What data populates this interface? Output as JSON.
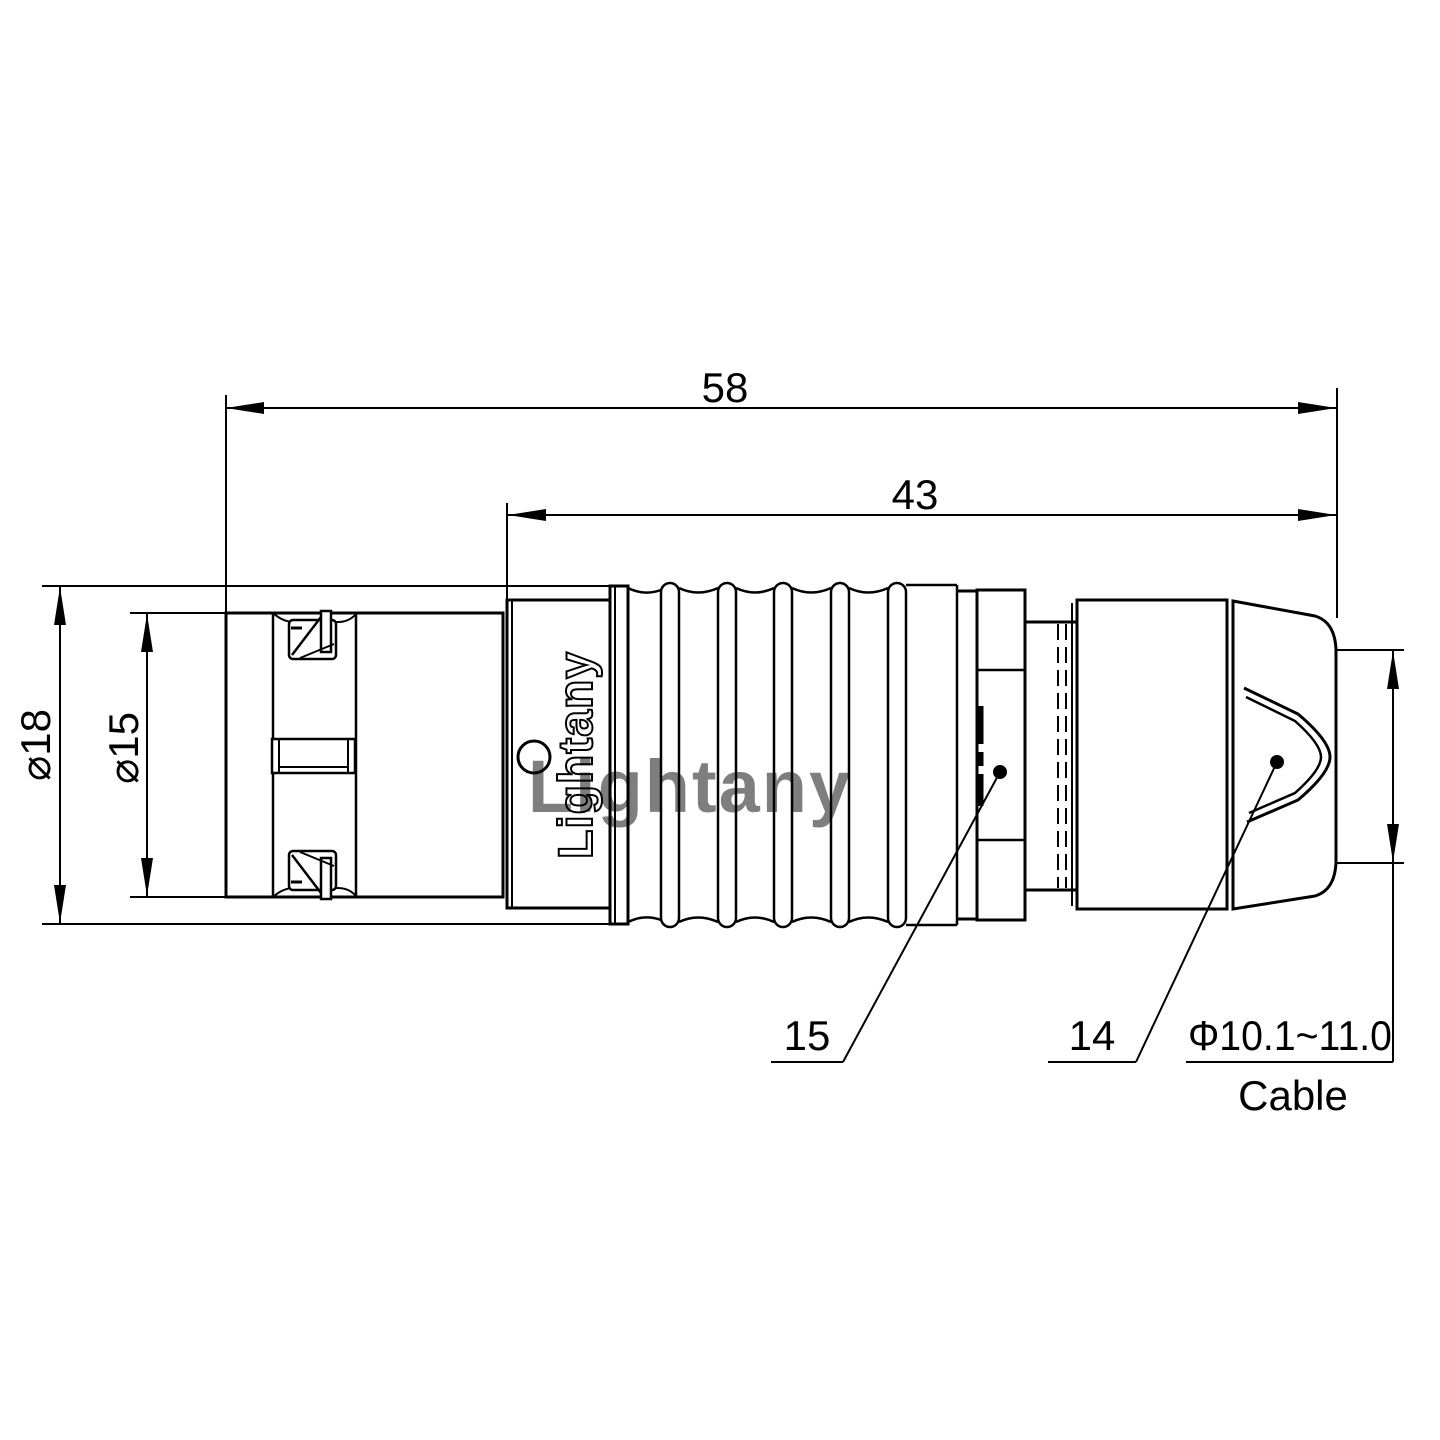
{
  "drawing": {
    "logo": "Lightany",
    "watermark": "Lightany",
    "dims": {
      "overall_length": "58",
      "body_length": "43",
      "outer_dia": "⌀18",
      "front_dia": "⌀15",
      "cable_dia_range": "Φ10.1~11.0",
      "cable_label": "Cable",
      "item_15": "15",
      "item_14": "14"
    },
    "colors": {
      "line": "#000000",
      "watermark": "#e9a0a0"
    }
  }
}
